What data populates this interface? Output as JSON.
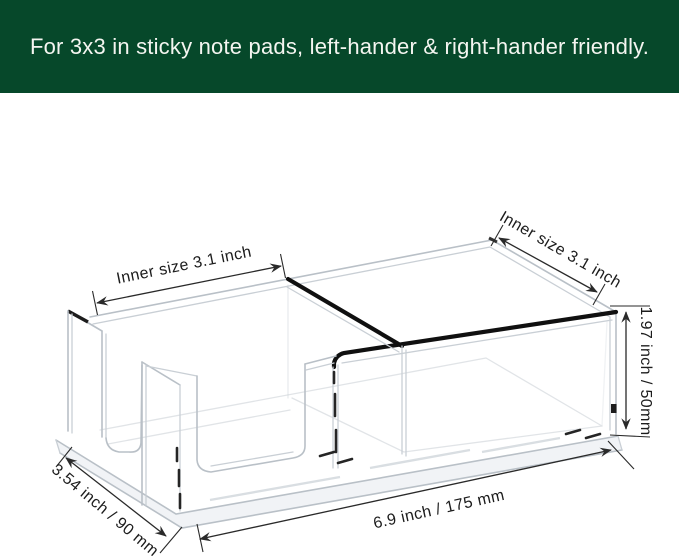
{
  "banner": {
    "text": "For 3x3 in sticky note pads, left-hander & right-hander friendly.",
    "bg_color": "#06482a",
    "text_color": "#f4f5f0"
  },
  "diagram": {
    "subject": "clear acrylic two-compartment sticky note holder, 3D dimension drawing",
    "line_color": "#b9c0c7",
    "accent_edge_color": "#101010",
    "annotation_color": "#1c1c1c",
    "annotations": {
      "inner_left": "Inner size 3.1 inch",
      "inner_right": "Inner size 3.1 inch",
      "height": "1.97 inch / 50mm",
      "depth": "3.54 inch / 90 mm",
      "length": "6.9 inch / 175 mm"
    }
  }
}
